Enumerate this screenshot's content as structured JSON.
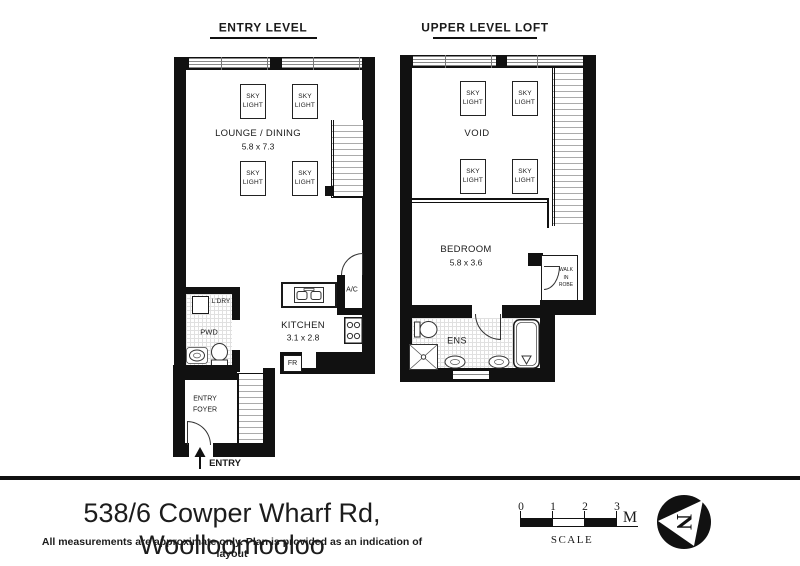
{
  "plans": [
    {
      "title": "ENTRY LEVEL",
      "labels": {
        "lounge": "LOUNGE / DINING",
        "lounge_dims": "5.8 x 7.3",
        "kitchen": "KITCHEN",
        "kitchen_dims": "3.1 x 2.8",
        "laundry": "L'DRY",
        "powder": "PWD",
        "ac": "A/C",
        "fridge": "FR",
        "entry_foyer": "ENTRY\nFOYER",
        "entry": "ENTRY"
      }
    },
    {
      "title": "UPPER LEVEL LOFT",
      "labels": {
        "void": "VOID",
        "bedroom": "BEDROOM",
        "bedroom_dims": "5.8 x 3.6",
        "ensuite": "ENS",
        "robe": "WALK\nIN\nROBE"
      }
    }
  ],
  "shared": {
    "skylight": "SKY\nLIGHT"
  },
  "footer": {
    "address": "538/6 Cowper Wharf Rd, Woolloomooloo",
    "disclaimer": "All measurements are approximate only. Plan is provided as an indication of layout",
    "scale": {
      "ticks": [
        "0",
        "1",
        "2",
        "3"
      ],
      "unit": "M",
      "label": "SCALE"
    },
    "north_letter": "N"
  },
  "colors": {
    "ink": "#111111",
    "background": "#ffffff"
  }
}
